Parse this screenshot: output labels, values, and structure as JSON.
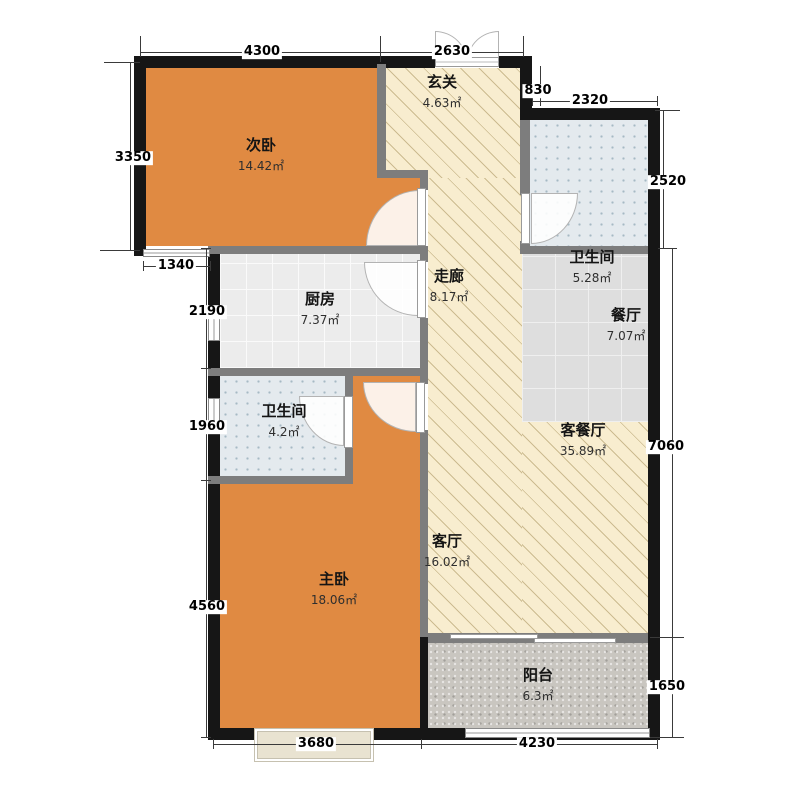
{
  "plan": {
    "width": 800,
    "height": 800,
    "rooms": [
      {
        "id": "secondary-bedroom",
        "name": "次卧",
        "area": "14.42㎡",
        "label": [
          261,
          154
        ],
        "floor": "wood",
        "rects": [
          [
            146,
            68,
            231,
            178
          ],
          [
            377,
            178,
            43,
            68
          ]
        ]
      },
      {
        "id": "entrance-hall",
        "name": "玄关",
        "area": "4.63㎡",
        "label": [
          442,
          91
        ],
        "floor": "hatch",
        "rects": [
          [
            386,
            68,
            134,
            110
          ]
        ]
      },
      {
        "id": "corridor",
        "name": "走廊",
        "area": "8.17㎡",
        "label": [
          449,
          285
        ],
        "floor": "hatch",
        "rects": [
          [
            428,
            178,
            94,
            459
          ]
        ]
      },
      {
        "id": "living-dining-room",
        "name": "客餐厅",
        "area": "35.89㎡",
        "label": [
          583,
          439
        ],
        "floor": "hatch",
        "rects": [
          [
            522,
            422,
            126,
            215
          ]
        ]
      },
      {
        "id": "living-room",
        "name": "客厅",
        "area": "16.02㎡",
        "label": [
          447,
          550
        ],
        "floor": "hatch",
        "rects": []
      },
      {
        "id": "bathroom-1",
        "name": "卫生间",
        "area": "5.28㎡",
        "label": [
          592,
          266
        ],
        "floor": "bath",
        "rects": [
          [
            530,
            120,
            118,
            126
          ]
        ]
      },
      {
        "id": "kitchen",
        "name": "厨房",
        "area": "7.37㎡",
        "label": [
          320,
          308
        ],
        "floor": "tile-k",
        "rects": [
          [
            220,
            254,
            200,
            114
          ]
        ]
      },
      {
        "id": "dining-room",
        "name": "餐厅",
        "area": "7.07㎡",
        "label": [
          626,
          324
        ],
        "floor": "tile-d",
        "rects": [
          [
            522,
            254,
            126,
            168
          ]
        ]
      },
      {
        "id": "bathroom-2",
        "name": "卫生间",
        "area": "4.2㎡",
        "label": [
          284,
          420
        ],
        "floor": "bath",
        "rects": [
          [
            220,
            376,
            125,
            100
          ]
        ]
      },
      {
        "id": "master-bedroom",
        "name": "主卧",
        "area": "18.06㎡",
        "label": [
          334,
          588
        ],
        "floor": "wood",
        "rects": [
          [
            220,
            484,
            200,
            244
          ],
          [
            353,
            376,
            67,
            108
          ]
        ]
      },
      {
        "id": "balcony",
        "name": "阳台",
        "area": "6.3㎡",
        "label": [
          538,
          684
        ],
        "floor": "pebble",
        "rects": [
          [
            428,
            643,
            220,
            85
          ]
        ]
      }
    ],
    "walls": {
      "exterior": [
        [
          134,
          56,
          301,
          12
        ],
        [
          499,
          56,
          33,
          12
        ],
        [
          520,
          56,
          12,
          64
        ],
        [
          532,
          108,
          128,
          12
        ],
        [
          648,
          108,
          12,
          632
        ],
        [
          134,
          56,
          12,
          200
        ],
        [
          208,
          246,
          12,
          494
        ],
        [
          208,
          728,
          452,
          12
        ],
        [
          420,
          637,
          8,
          103
        ]
      ],
      "interior": [
        [
          377,
          64,
          9,
          114
        ],
        [
          377,
          170,
          51,
          8
        ],
        [
          420,
          178,
          8,
          12
        ],
        [
          420,
          246,
          8,
          16
        ],
        [
          208,
          246,
          220,
          8
        ],
        [
          420,
          318,
          8,
          66
        ],
        [
          420,
          430,
          8,
          207
        ],
        [
          208,
          368,
          220,
          8
        ],
        [
          345,
          376,
          8,
          22
        ],
        [
          345,
          446,
          8,
          34
        ],
        [
          208,
          476,
          145,
          8
        ],
        [
          520,
          120,
          10,
          75
        ],
        [
          520,
          241,
          10,
          13
        ],
        [
          520,
          246,
          128,
          8
        ],
        [
          428,
          633,
          220,
          10
        ]
      ]
    },
    "doors": {
      "entry": {
        "disc_left": [
          435,
          31,
          32,
          31
        ],
        "disc_right": [
          467,
          31,
          32,
          31
        ],
        "sill": [
          435,
          57,
          64,
          10
        ]
      },
      "swing": [
        {
          "id": "secondary-bedroom-door",
          "disc": [
            366,
            190,
            54,
            56
          ],
          "corner": "tl",
          "leaf": [
            417,
            188,
            9,
            58
          ]
        },
        {
          "id": "kitchen-door",
          "disc": [
            364,
            262,
            54,
            54
          ],
          "corner": "bl",
          "leaf": [
            417,
            260,
            9,
            58
          ]
        },
        {
          "id": "master-bedroom-door",
          "disc": [
            363,
            382,
            53,
            50
          ],
          "corner": "bl",
          "leaf": [
            416,
            382,
            9,
            51
          ]
        },
        {
          "id": "bathroom-1-door",
          "disc": [
            531,
            193,
            47,
            51
          ],
          "corner": "br",
          "leaf": [
            521,
            193,
            9,
            51
          ]
        },
        {
          "id": "bathroom-2-door",
          "disc": [
            299,
            396,
            45,
            50
          ],
          "corner": "bl",
          "leaf": [
            344,
            396,
            9,
            52
          ]
        }
      ],
      "sliding_panels": [
        [
          450,
          634,
          88,
          5
        ],
        [
          534,
          638,
          82,
          5
        ]
      ]
    },
    "windows": [
      {
        "id": "secondary-bedroom-window",
        "type": "h",
        "rect": [
          143,
          249,
          67,
          8
        ]
      },
      {
        "id": "kitchen-window",
        "type": "v",
        "rect": [
          208,
          310,
          12,
          31
        ]
      },
      {
        "id": "bathroom-2-window",
        "type": "v",
        "rect": [
          208,
          398,
          12,
          26
        ]
      },
      {
        "id": "balcony-window",
        "type": "h",
        "rect": [
          465,
          728,
          185,
          10
        ]
      },
      {
        "id": "master-bay-window",
        "type": "bay",
        "rect": [
          255,
          729,
          118,
          32
        ]
      }
    ],
    "dim_labels": [
      {
        "text": "4300",
        "x": 262,
        "y": 52
      },
      {
        "text": "2630",
        "x": 452,
        "y": 52
      },
      {
        "text": "830",
        "x": 538,
        "y": 91
      },
      {
        "text": "2320",
        "x": 590,
        "y": 101
      },
      {
        "text": "2520",
        "x": 668,
        "y": 182
      },
      {
        "text": "3350",
        "x": 133,
        "y": 158
      },
      {
        "text": "1340",
        "x": 176,
        "y": 266
      },
      {
        "text": "2190",
        "x": 207,
        "y": 312
      },
      {
        "text": "1960",
        "x": 207,
        "y": 427
      },
      {
        "text": "4560",
        "x": 207,
        "y": 607
      },
      {
        "text": "7060",
        "x": 666,
        "y": 447
      },
      {
        "text": "1650",
        "x": 667,
        "y": 687
      },
      {
        "text": "3680",
        "x": 316,
        "y": 744
      },
      {
        "text": "4230",
        "x": 537,
        "y": 744
      }
    ],
    "lines": [
      [
        "h",
        140,
        52,
        383
      ],
      [
        "h",
        532,
        101,
        125
      ],
      [
        "v",
        540,
        66,
        40
      ],
      [
        "v",
        130,
        62,
        188
      ],
      [
        "h",
        143,
        266,
        67
      ],
      [
        "v",
        206,
        248,
        489
      ],
      [
        "v",
        663,
        110,
        138
      ],
      [
        "v",
        672,
        248,
        489
      ],
      [
        "h",
        213,
        744,
        444
      ],
      [
        "h",
        104,
        62,
        36
      ],
      [
        "h",
        100,
        250,
        40
      ],
      [
        "v",
        140,
        36,
        16
      ],
      [
        "v",
        380,
        36,
        26
      ],
      [
        "v",
        523,
        36,
        16
      ],
      [
        "h",
        655,
        110,
        25
      ],
      [
        "h",
        650,
        637,
        34
      ],
      [
        "h",
        650,
        737,
        34
      ],
      [
        "v",
        140,
        47,
        10
      ],
      [
        "v",
        380,
        47,
        10
      ],
      [
        "v",
        523,
        47,
        10
      ],
      [
        "v",
        532,
        96,
        10
      ],
      [
        "v",
        657,
        96,
        10
      ],
      [
        "h",
        125,
        62,
        10
      ],
      [
        "h",
        125,
        250,
        10
      ],
      [
        "v",
        143,
        261,
        10
      ],
      [
        "v",
        210,
        261,
        10
      ],
      [
        "h",
        201,
        248,
        10
      ],
      [
        "h",
        201,
        368,
        10
      ],
      [
        "h",
        201,
        480,
        10
      ],
      [
        "h",
        201,
        737,
        10
      ],
      [
        "h",
        658,
        110,
        10
      ],
      [
        "h",
        658,
        248,
        10
      ],
      [
        "h",
        667,
        248,
        10
      ],
      [
        "h",
        667,
        637,
        10
      ],
      [
        "h",
        667,
        737,
        10
      ],
      [
        "v",
        213,
        739,
        10
      ],
      [
        "v",
        421,
        739,
        10
      ],
      [
        "v",
        657,
        739,
        10
      ]
    ]
  }
}
